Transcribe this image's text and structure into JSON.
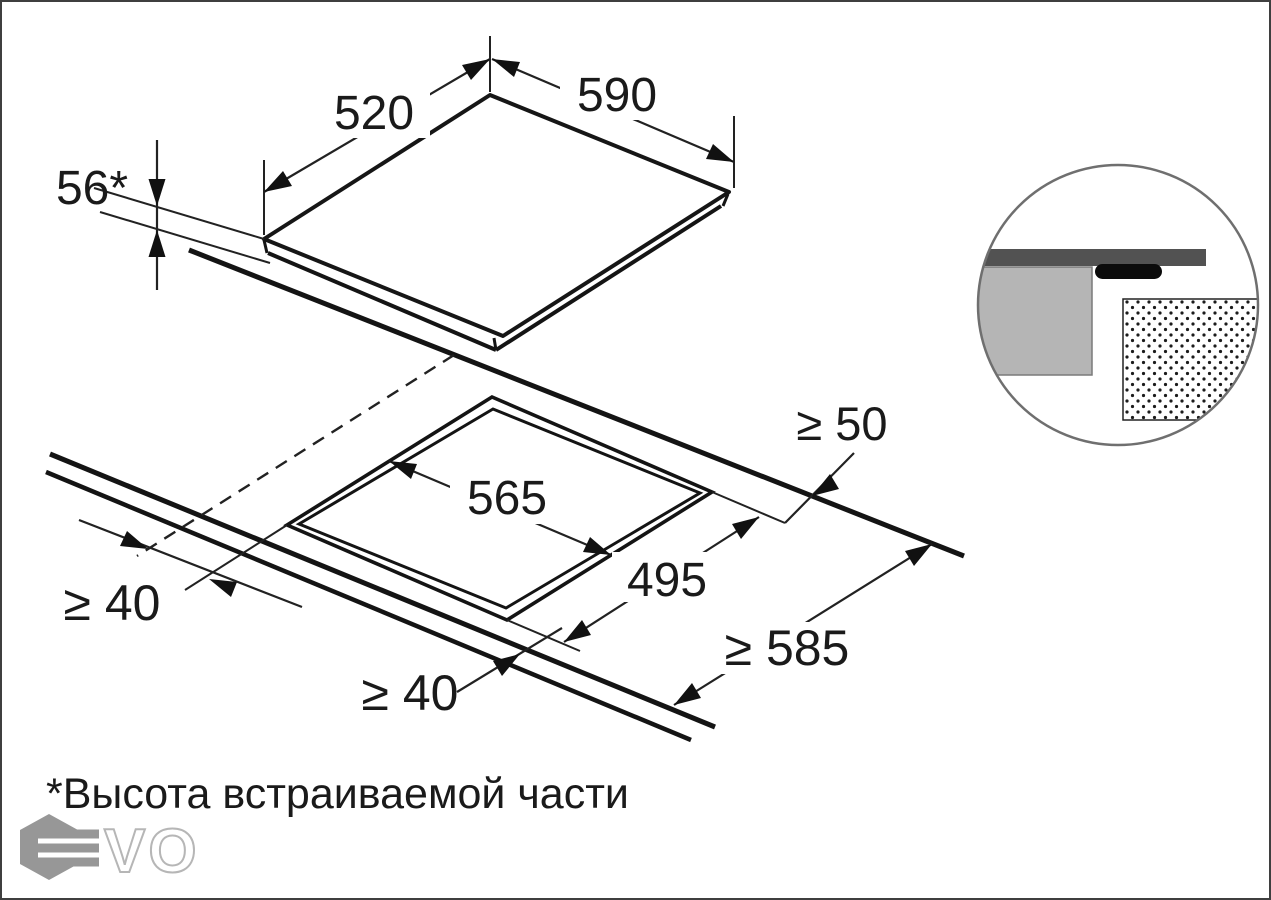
{
  "title": "appliance built-in installation drawing",
  "labels": {
    "dim_520": "520",
    "dim_590": "590",
    "dim_56": "56*",
    "dim_565": "565",
    "dim_495": "495",
    "min_50": "≥ 50",
    "min_40_left": "≥ 40",
    "min_40_front": "≥ 40",
    "min_585": "≥ 585"
  },
  "dimensions_mm": {
    "appliance_width": 590,
    "appliance_depth": 520,
    "built_in_height": 56,
    "cutout_width": 565,
    "cutout_depth": 495,
    "clearance_rear_min": 50,
    "clearance_side_min": 40,
    "clearance_front_min": 40,
    "worktop_depth_min": 585
  },
  "footnote": "*Высота встраиваемой части",
  "watermark": {
    "vo": "VO"
  },
  "colors": {
    "line": "#141414",
    "worktop_fill": "#b5b5b5",
    "glass_strip": "#555555",
    "seal": "#0b0b0b",
    "watermark_gray": "#8f8f8f"
  }
}
